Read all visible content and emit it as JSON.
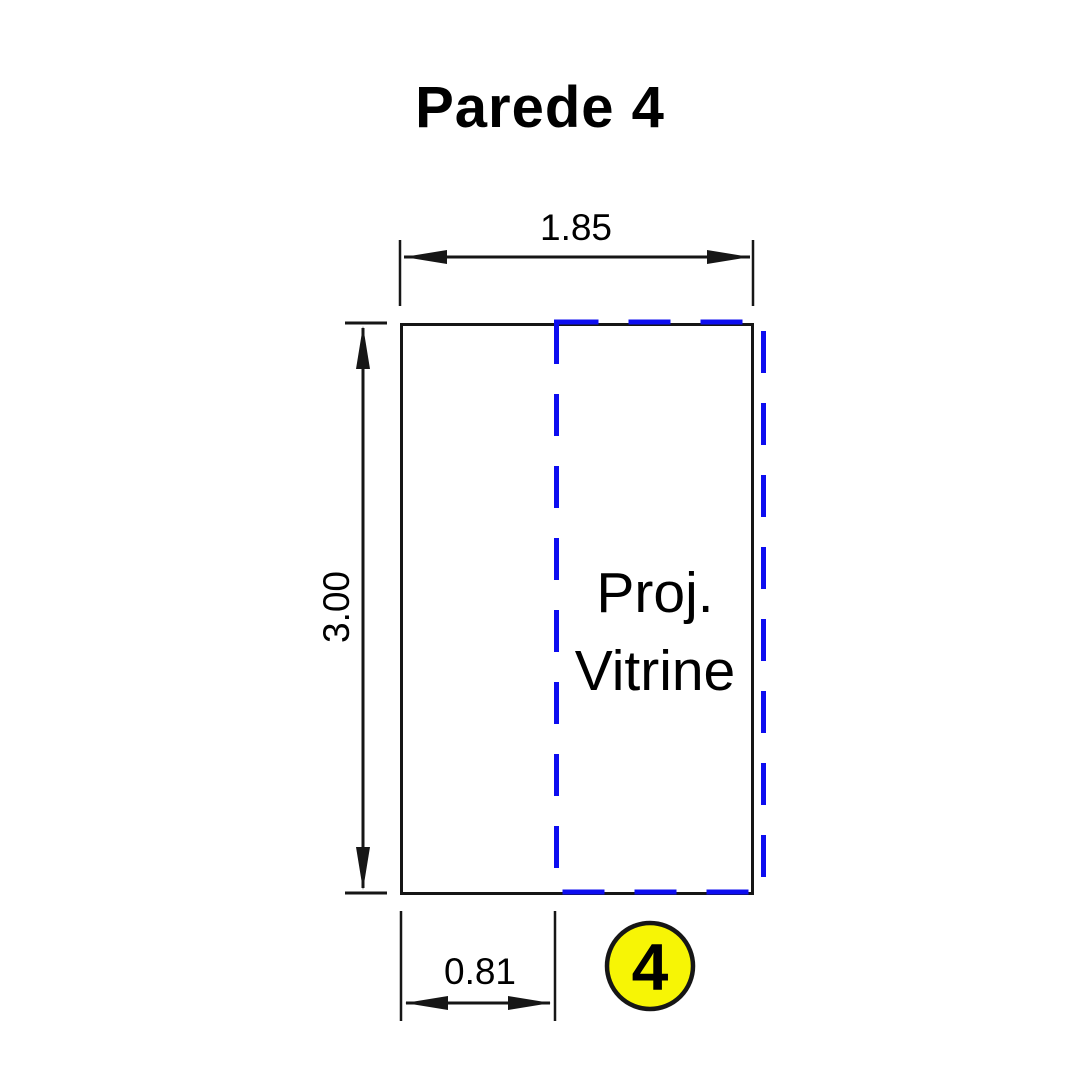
{
  "title": "Parede 4",
  "wall": {
    "label_line1": "Proj.",
    "label_line2": "Vitrine"
  },
  "dimensions": {
    "width_total": "1.85",
    "height_total": "3.00",
    "offset_left": "0.81"
  },
  "marker": {
    "number": "4"
  },
  "colors": {
    "line": "#161616",
    "dashed_outline": "#0d0df0",
    "marker_fill": "#f7f505",
    "wall_light": "#f6f6f6",
    "wall_mid": "#dededf",
    "wall_dark": "#c7c7cb"
  }
}
